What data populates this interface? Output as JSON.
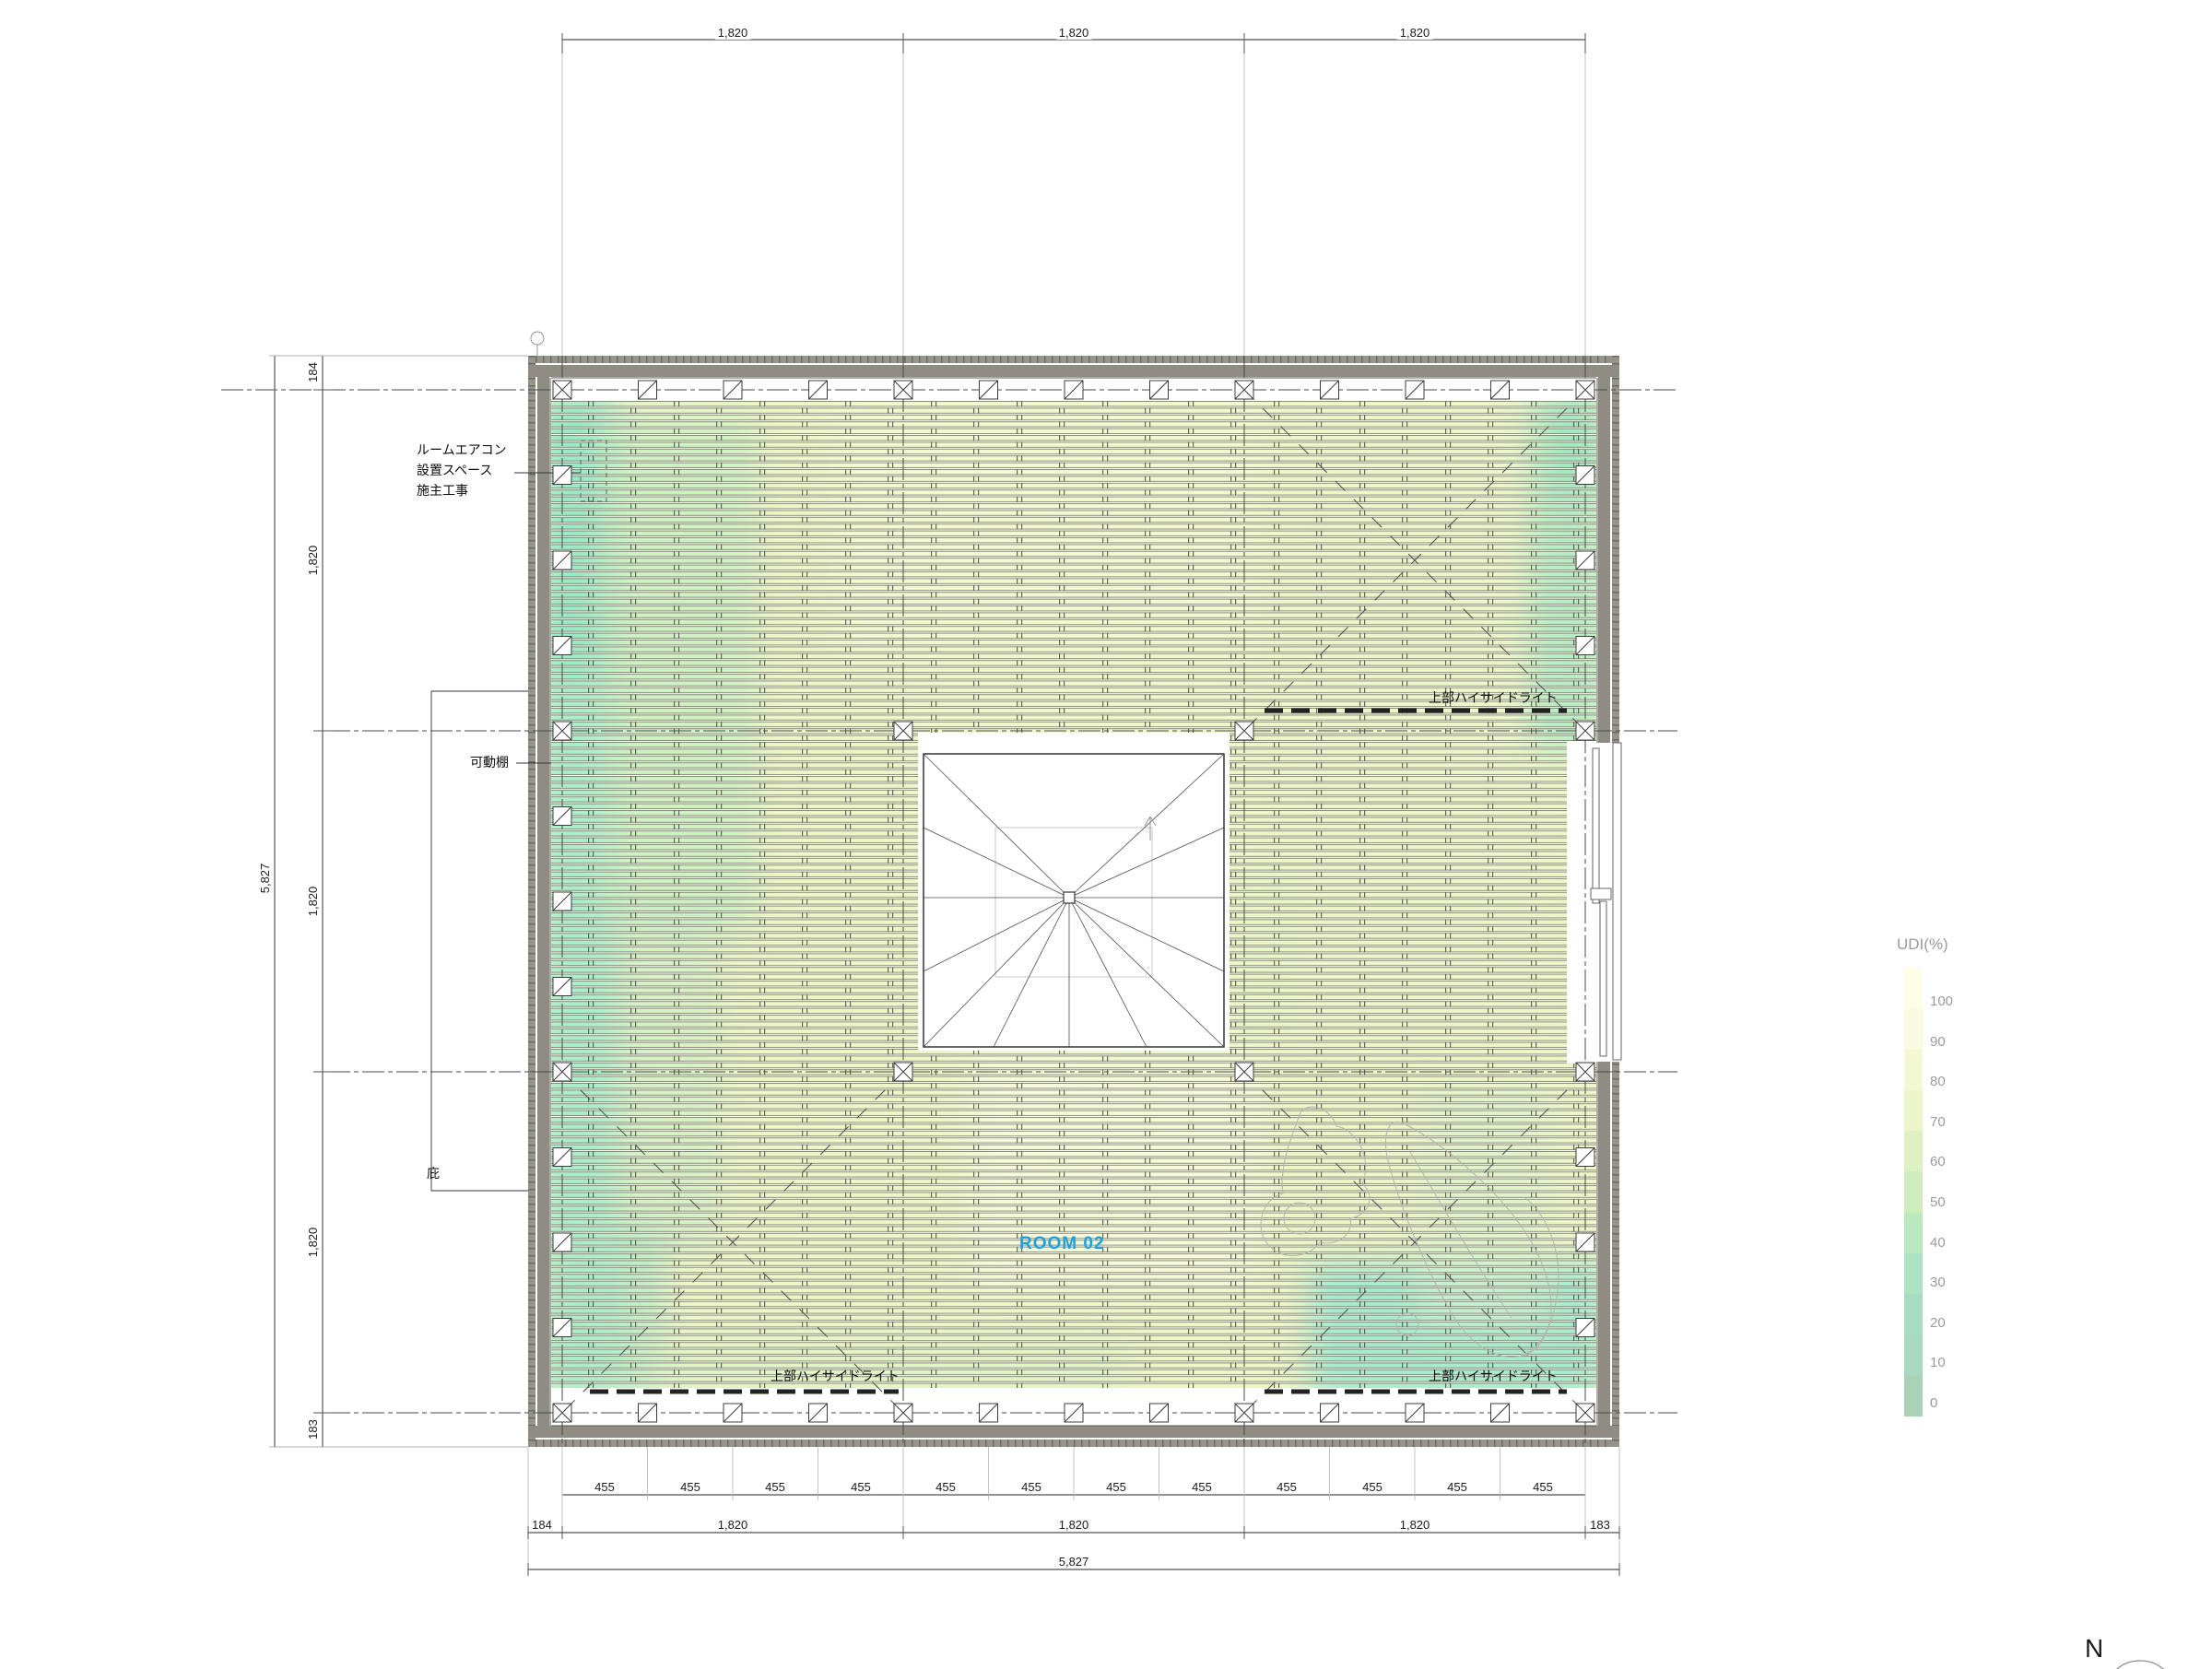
{
  "plan": {
    "room_label": "ROOM 02",
    "room_label_color": "#1ba1e3",
    "annotations": {
      "aircon_line1": "ルームエアコン",
      "aircon_line2": "設置スペース",
      "aircon_line3": "施主工事",
      "movable_shelf": "可動棚",
      "eave": "庇",
      "high_sidelight_ne": "上部ハイサイドライト",
      "high_sidelight_sw": "上部ハイサイドライト",
      "high_sidelight_se": "上部ハイサイドライト"
    },
    "compass_north": "N"
  },
  "dims": {
    "top": [
      "1,820",
      "1,820",
      "1,820"
    ],
    "left_total": "5,827",
    "left": [
      "184",
      "1,820",
      "1,820",
      "1,820",
      "183"
    ],
    "bottom_455": [
      "455",
      "455",
      "455",
      "455",
      "455",
      "455",
      "455",
      "455",
      "455",
      "455",
      "455",
      "455"
    ],
    "bottom_mid": [
      "184",
      "1,820",
      "1,820",
      "1,820",
      "183"
    ],
    "bottom_total": "5,827"
  },
  "legend": {
    "title": "UDI(%)",
    "ticks": [
      "100",
      "90",
      "80",
      "70",
      "60",
      "50",
      "40",
      "30",
      "20",
      "10",
      "0"
    ],
    "colors": [
      "#fdfde8",
      "#f9fadf",
      "#f3f8d3",
      "#ebf5c9",
      "#dff1c2",
      "#cdedbc",
      "#bae8bf",
      "#ace3c1",
      "#a7dec2",
      "#a8d8bf",
      "#aad2b6"
    ]
  }
}
